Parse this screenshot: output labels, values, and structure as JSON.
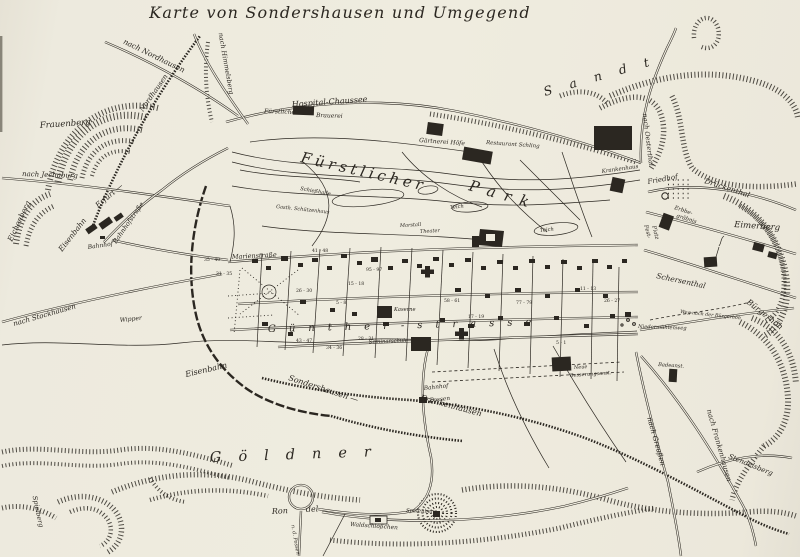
{
  "map": {
    "title": "Karte von Sondershausen und Umgegend",
    "colors": {
      "paper": "#efecdf",
      "ink": "#2b2721"
    },
    "regions": {
      "fuerstlicher": "Fürstlicher",
      "park": "Park",
      "sandt": "Sandt",
      "goeldner": "Göldner"
    },
    "labels": {
      "nach_nordhausen": "nach Nordhausen",
      "nach_himmelsberg": "nach Himmelsberg",
      "frauenberg": "Frauenberg",
      "nach_jechaburg": "nach Jechaburg",
      "eichenberg": "Eichenberg",
      "eisenbahn_w": "Eisenbahn",
      "erfurt_w": "Erfurt —",
      "nordhausen_w": "Nordhausen",
      "bahnhof": "Bahnhof",
      "bahnhofstrasse": "Bahnhofstraße",
      "nach_stockhausen": "nach Stockhausen",
      "wipper": "Wipper",
      "hospital_chaussee": "Hospital-Chaussee",
      "fuerstliche": "Fürstliche",
      "brauerei": "Brauerei",
      "gaertnerei": "Gärtnerei Höfe",
      "restaurant": "Restaurant Schling",
      "krankenhaus": "Krankenhaus",
      "nach_oesterthal": "nach Oesterthal",
      "friedhof": "Friedhof",
      "drueckenthal": "Drückenthal",
      "erbbe": "Erbbe-",
      "graebnis": "gräbnis",
      "fest": "Fest-",
      "platz": "Platz",
      "eimerberg": "Eimerberg",
      "schersenthal": "Schersenthal",
      "buergerhoeh": "Bürgerhöh",
      "weg_buergerhoeh": "Weg nach der Bürgerhöh",
      "niedermuehlenweg": "Niedermühlenweg",
      "badeanstalt": "Badeanst.",
      "nach_greussen": "nach Greußen",
      "nach_frankenhausen": "nach Frankenhausen",
      "stendelsberg": "Stendelsberg",
      "marienstrasse": "Marienstraße",
      "guentherstrasse": "Günther-strasse",
      "schiesshalle": "Schießhalle",
      "schuetzenhaus": "Gasth. Schützenhaus",
      "marstall": "Marstall",
      "theater": "Theater",
      "teich1": "Teich",
      "teich2": "Teich",
      "kaserne": "Kaserne",
      "seminarschule": "Seminarschule",
      "neue": "Neue",
      "besserung": "Besserungsanst.",
      "eisenbahn_s": "Eisenbahn",
      "sondershausen_s": "Sondershausen —",
      "frankenhausen_s": "Frankenhausen",
      "bahnhof_possen_1": "Bahnhof",
      "bahnhof_possen_2": "Possen",
      "rondel_1": "Ron",
      "rondel_2": "del",
      "nd_possen": "n. d. Possen",
      "waldschloesschen": "Waldschlößchen",
      "spatenberg": "Spatenberg",
      "spielberg": "Spielberg"
    },
    "house_numbers": [
      "35 - 40",
      "31 - 35",
      "41 - 48",
      "95 - 97",
      "15 - 18",
      "26 - 30",
      "5 - 8",
      "43 - 47",
      "34 - 36",
      "28 - 31",
      "58 - 61",
      "17 - 19",
      "77 - 79",
      "11 - 13",
      "5 - 1",
      "26 - 27"
    ]
  }
}
